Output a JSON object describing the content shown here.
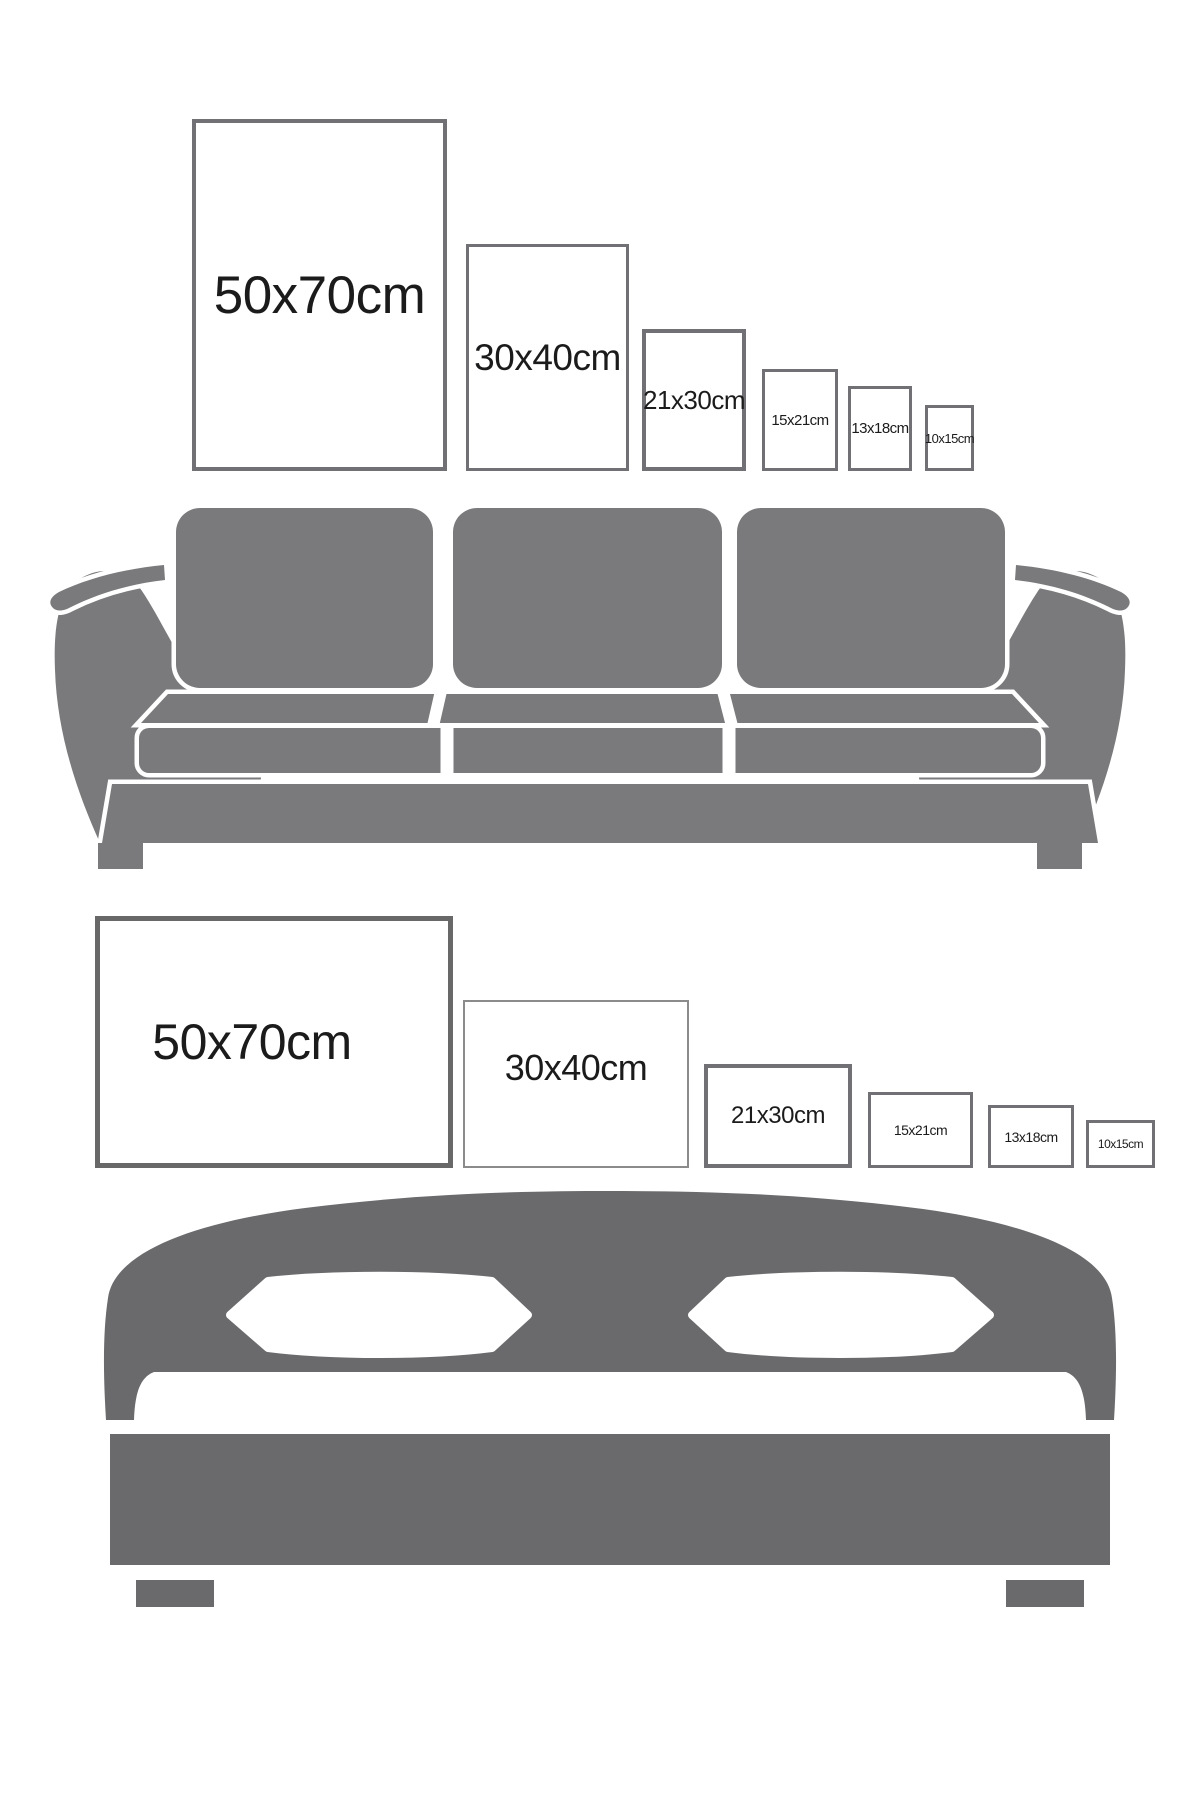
{
  "colors": {
    "background": "#ffffff",
    "frame_border": "#717175",
    "frame_border_dark": "#686868",
    "frame_border_light": "#8b8b8b",
    "label_text": "#1b1b1b",
    "sofa_gray": "#7a7a7c",
    "bed_gray": "#6a6a6d"
  },
  "sections": [
    {
      "id": "sofa-size-guide",
      "furniture": "sofa",
      "frame_orientation": "portrait",
      "frames": [
        {
          "label": "50x70cm"
        },
        {
          "label": "30x40cm"
        },
        {
          "label": "21x30cm"
        },
        {
          "label": "15x21cm"
        },
        {
          "label": "13x18cm"
        },
        {
          "label": "10x15cm"
        }
      ]
    },
    {
      "id": "bed-size-guide",
      "furniture": "bed",
      "frame_orientation": "landscape",
      "frames": [
        {
          "label": "50x70cm"
        },
        {
          "label": "30x40cm"
        },
        {
          "label": "21x30cm"
        },
        {
          "label": "15x21cm"
        },
        {
          "label": "13x18cm"
        },
        {
          "label": "10x15cm"
        }
      ]
    }
  ]
}
